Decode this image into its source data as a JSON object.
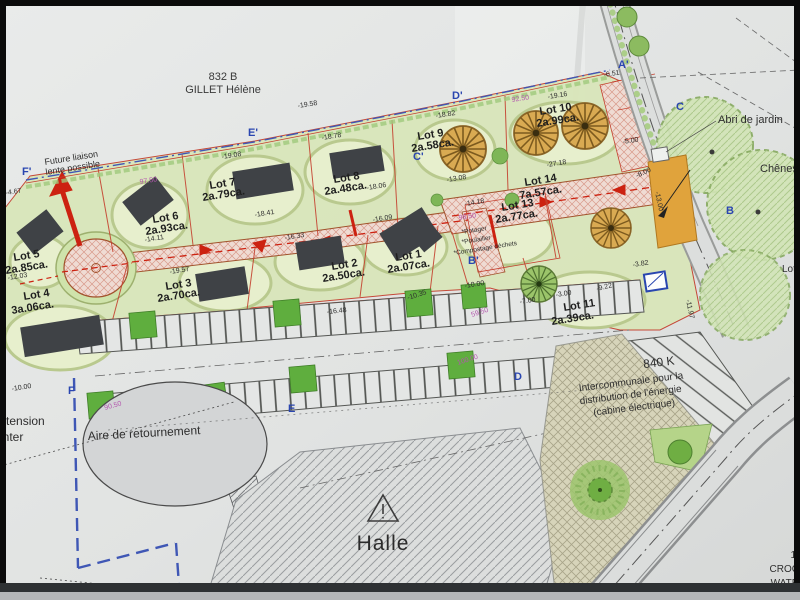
{
  "plan": {
    "parcel_ref": "832 B",
    "parcel_owner": "GILLET Hélène",
    "future_link_1": "Future liaison",
    "future_link_2": "lente possible",
    "abri_jardin": "Abri de jardin",
    "chenes": "Chênes",
    "aire_retournement": "Aire de retournement",
    "halle": "Halle",
    "left_cut_1": "e tension",
    "left_cut_2": "onter",
    "lot_cut_right": "Lot",
    "elec": {
      "l1": "840 K",
      "l2": "Intercommunale pour la",
      "l3": "distribution de l'énergie",
      "l4": "(cabine électrique)"
    },
    "corner": {
      "l1": "1",
      "l2": "CROC",
      "l3": "WATR"
    }
  },
  "lots": [
    {
      "name": "Lot 1",
      "area": "2a.07ca."
    },
    {
      "name": "Lot 2",
      "area": "2a.50ca."
    },
    {
      "name": "Lot 3",
      "area": "2a.70ca."
    },
    {
      "name": "Lot 4",
      "area": "3a.06ca."
    },
    {
      "name": "Lot 5",
      "area": "2a.85ca."
    },
    {
      "name": "Lot 6",
      "area": "2a.93ca."
    },
    {
      "name": "Lot 7",
      "area": "2a.79ca."
    },
    {
      "name": "Lot 8",
      "area": "2a.48ca."
    },
    {
      "name": "Lot 9",
      "area": "2a.58ca."
    },
    {
      "name": "Lot 10",
      "area": "2a.99ca."
    },
    {
      "name": "Lot 11",
      "area": "2a.39ca."
    },
    {
      "name": "Lot 13",
      "area": "2a.77ca."
    },
    {
      "name": "Lot 14",
      "area": "7a.57ca."
    }
  ],
  "lot13_items": [
    "*Potager",
    "*Poulailler",
    "*Compostage déchets"
  ],
  "markers": {
    "fp": "F'",
    "ep": "E'",
    "dp": "D'",
    "cp": "C'",
    "bp": "B'",
    "ap": "A'",
    "c": "C",
    "b": "B",
    "f": "F",
    "d": "D",
    "e": "E"
  },
  "meas": {
    "m01": "-19.58",
    "m02": "-19.08",
    "m03": "-18.78",
    "m04": "-18.82",
    "m05": "92.50",
    "m06": "-19.16",
    "m07": "97.50",
    "m08": "-18.41",
    "m09": "-18.06",
    "m10": "-16.33",
    "m11": "-16.09",
    "m12": "-14.11",
    "m13": "-19.57",
    "m14": "-13.08",
    "m15": "-14.18",
    "m16": "98.50",
    "m17": "-27.18",
    "m18": "-12.03",
    "m19": "-4.67",
    "m20": "-10.00",
    "m21": "-16.48",
    "m22": "-10.35",
    "m23": "-10.00",
    "m24": "59.50",
    "m25": "100.00",
    "m26": "90.50",
    "m27": "-6.51",
    "m28": "-5.00",
    "m29": "-8.00",
    "m30": "-13.00",
    "m31": "-3.82",
    "m32": "-3.00",
    "m33": "-9.22",
    "m34": "-7.00",
    "m35": "-11.97"
  },
  "colors": {
    "lot_green": "#d9e6ba",
    "road_pink": "#efdbd3",
    "boundary_red": "#c4402f",
    "marker_blue": "#2a46b0",
    "dim_magenta": "#b357ae",
    "building_gray": "#3f4246"
  }
}
